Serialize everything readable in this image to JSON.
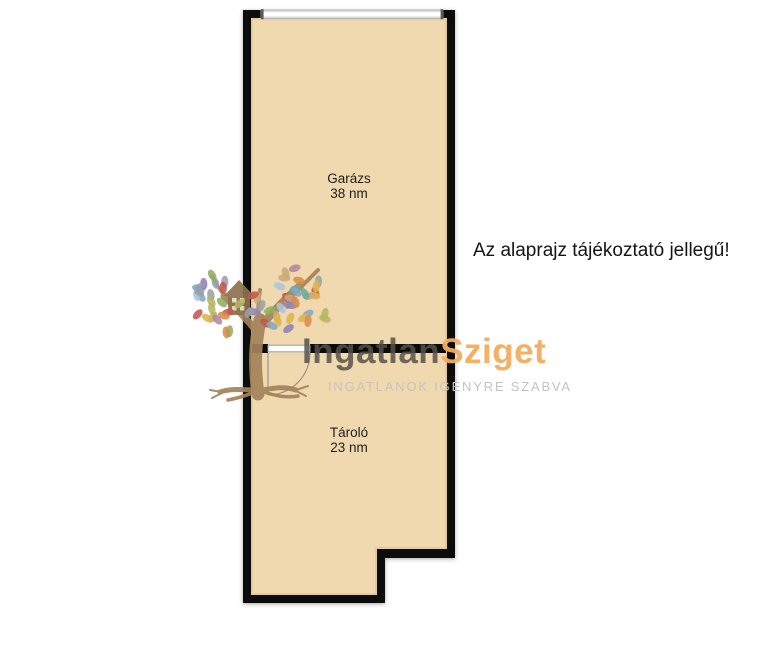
{
  "floorplan": {
    "rooms": [
      {
        "name": "Garázs",
        "area": "38 nm"
      },
      {
        "name": "Tároló",
        "area": "23 nm"
      }
    ],
    "disclaimer": "Az alaprajz tájékoztató jellegű!",
    "colors": {
      "wall": "#0c0c0c",
      "floor": "#f1d9af",
      "door_line": "#909090",
      "garage_door_fill": "#f4f4f4",
      "label_text": "#1e1e1e"
    }
  },
  "watermark": {
    "brand_primary": "Ingatlan",
    "brand_secondary": "Sziget",
    "tagline": "INGATLANOK IGÉNYRE SZABVA",
    "colors": {
      "primary_text": "#56524a",
      "secondary_text": "#f3ac5c",
      "tagline_text": "#c6c3bc",
      "trunk": "#a3835a",
      "house": "#8f744e",
      "house_window": "#e9dcc2",
      "leaves": [
        "#c4584e",
        "#d98c4a",
        "#ddb54f",
        "#b5b561",
        "#8fae62",
        "#6fa99e",
        "#7fa8c6",
        "#a9c6dc",
        "#8d82b4",
        "#b286a0",
        "#c9a87c",
        "#98a0a8"
      ]
    }
  }
}
